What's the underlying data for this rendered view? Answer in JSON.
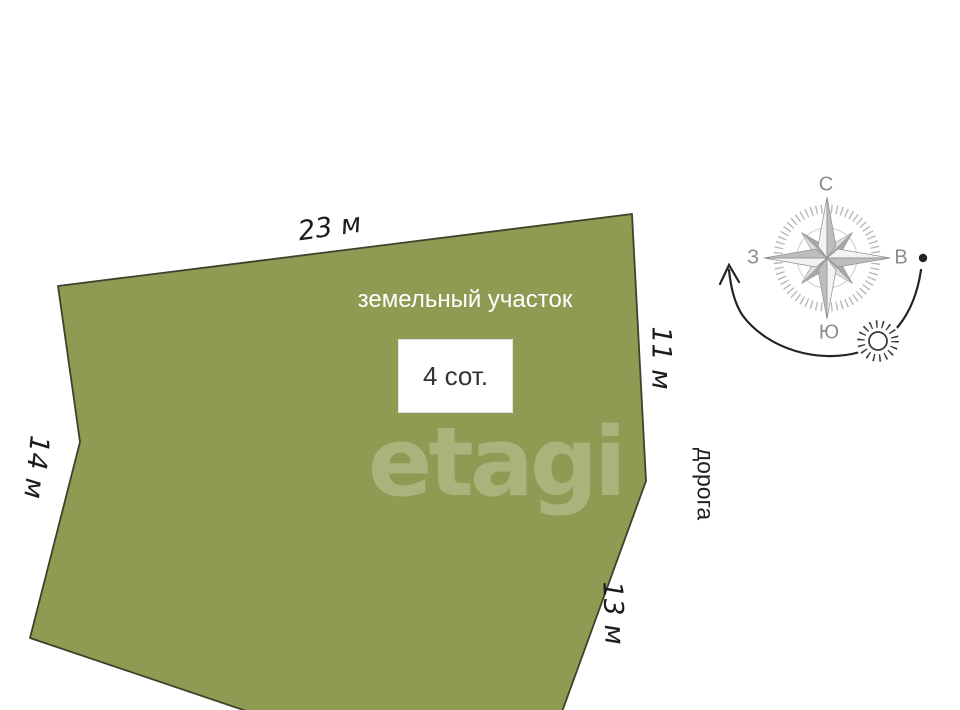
{
  "plot": {
    "label": "земельный участок",
    "area_label": "4 сот.",
    "watermark": "etagi"
  },
  "dimensions": {
    "top": "23 м",
    "right": "11 м",
    "left": "14 м",
    "bottom": "13 м"
  },
  "road_label": "дорога",
  "compass": {
    "north": "С",
    "east": "В",
    "south": "Ю",
    "west": "З"
  },
  "colors": {
    "plot_fill": "#8f9a52",
    "plot_stroke": "#3f422b",
    "compass_tick": "#b9b9b9",
    "compass_circle": "#cdcdcd",
    "arrow": "#242424",
    "sun": "#3c3c3c"
  }
}
